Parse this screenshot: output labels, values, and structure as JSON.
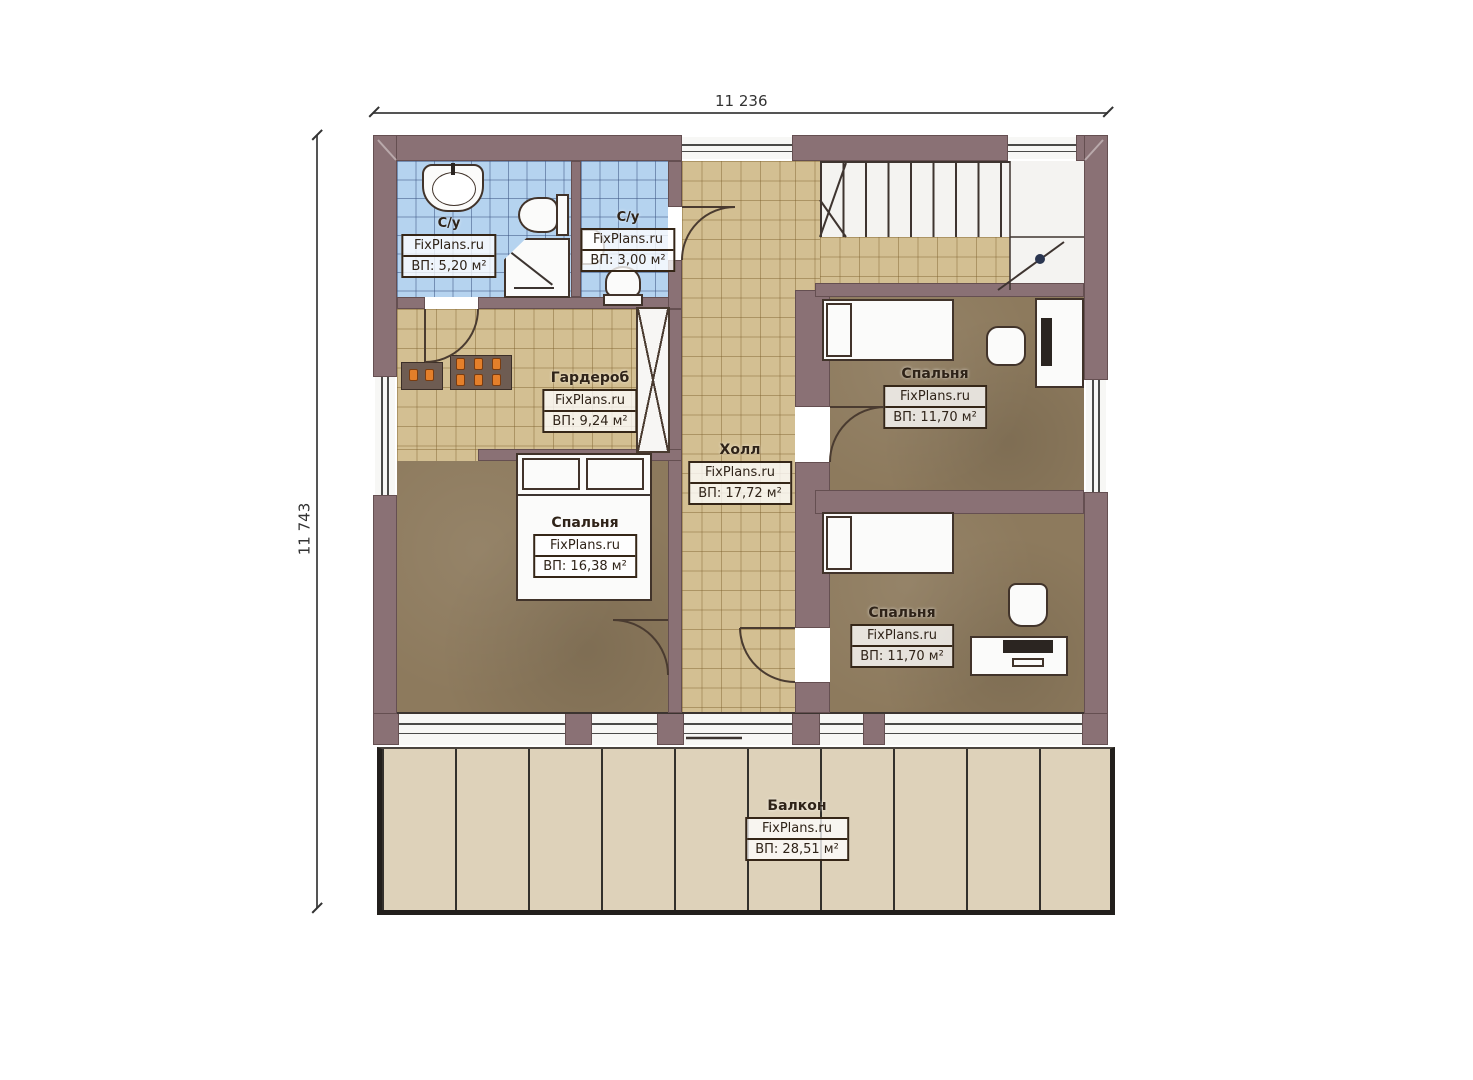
{
  "drawing": {
    "type": "floor-plan",
    "watermark": "FixPlans.ru",
    "dimensions": {
      "top_width": "11 236",
      "left_height": "11 743"
    }
  },
  "rooms": [
    {
      "id": "bathroom-1",
      "name": "С/у",
      "brand": "FixPlans.ru",
      "area": "ВП: 5,20 м²"
    },
    {
      "id": "bathroom-2",
      "name": "С/у",
      "brand": "FixPlans.ru",
      "area": "ВП: 3,00 м²"
    },
    {
      "id": "wardrobe",
      "name": "Гардероб",
      "brand": "FixPlans.ru",
      "area": "ВП: 9,24 м²"
    },
    {
      "id": "hall",
      "name": "Холл",
      "brand": "FixPlans.ru",
      "area": "ВП: 17,72 м²"
    },
    {
      "id": "bedroom-left",
      "name": "Спальня",
      "brand": "FixPlans.ru",
      "area": "ВП: 16,38 м²"
    },
    {
      "id": "bedroom-top-right",
      "name": "Спальня",
      "brand": "FixPlans.ru",
      "area": "ВП: 11,70 м²"
    },
    {
      "id": "bedroom-bottom-right",
      "name": "Спальня",
      "brand": "FixPlans.ru",
      "area": "ВП: 11,70 м²"
    },
    {
      "id": "balcony",
      "name": "Балкон",
      "brand": "FixPlans.ru",
      "area": "ВП: 28,51 м²"
    }
  ],
  "colors": {
    "wall": "#8a7175",
    "bathroom_tile": "#b5d3ef",
    "corridor_tile": "#d3bf92",
    "bedroom_floor": "#8d7a5d",
    "balcony_floor": "#ded2ba",
    "label_ink": "#2f2318"
  }
}
